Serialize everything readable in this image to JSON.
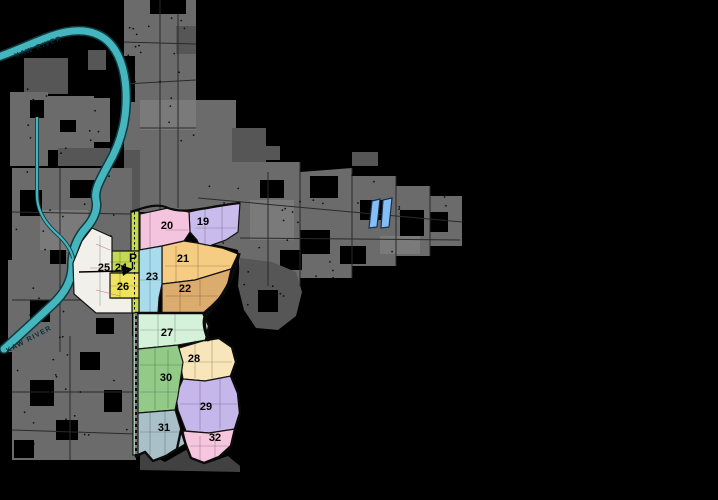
{
  "map": {
    "river": {
      "name_top": "KAW RIVER",
      "name_bottom": "KAW RIVER"
    },
    "marker": {
      "label": "P"
    },
    "zones": [
      {
        "id": 19,
        "label": "19",
        "color": "#c9bcec"
      },
      {
        "id": 20,
        "label": "20",
        "color": "#f4c3de"
      },
      {
        "id": 21,
        "label": "21",
        "color": "#f6cb82"
      },
      {
        "id": 22,
        "label": "22",
        "color": "#dcab6e"
      },
      {
        "id": 23,
        "label": "23",
        "color": "#a8dcec"
      },
      {
        "id": 24,
        "label": "24",
        "color": "#c3d94f"
      },
      {
        "id": 25,
        "label": "25",
        "color": "#f2f0ea"
      },
      {
        "id": 26,
        "label": "26",
        "color": "#efe25e"
      },
      {
        "id": 27,
        "label": "27",
        "color": "#d4f2da"
      },
      {
        "id": 28,
        "label": "28",
        "color": "#f8e6ba"
      },
      {
        "id": 29,
        "label": "29",
        "color": "#c6b7ea"
      },
      {
        "id": 30,
        "label": "30",
        "color": "#92ca88"
      },
      {
        "id": 31,
        "label": "31",
        "color": "#a9c0c8"
      },
      {
        "id": 32,
        "label": "32",
        "color": "#f5c6dd"
      }
    ],
    "colors": {
      "background": "#000000",
      "land": "#6b6b6b",
      "land_dark": "#565656",
      "land_light": "#7a7a7a",
      "river_fill": "#45b6bd",
      "river_outline": "#0e3c42",
      "lake_fill": "#85bdf5",
      "lake_outline": "#16304e",
      "label_text": "#000000",
      "river_label_text": "#06303a"
    }
  }
}
